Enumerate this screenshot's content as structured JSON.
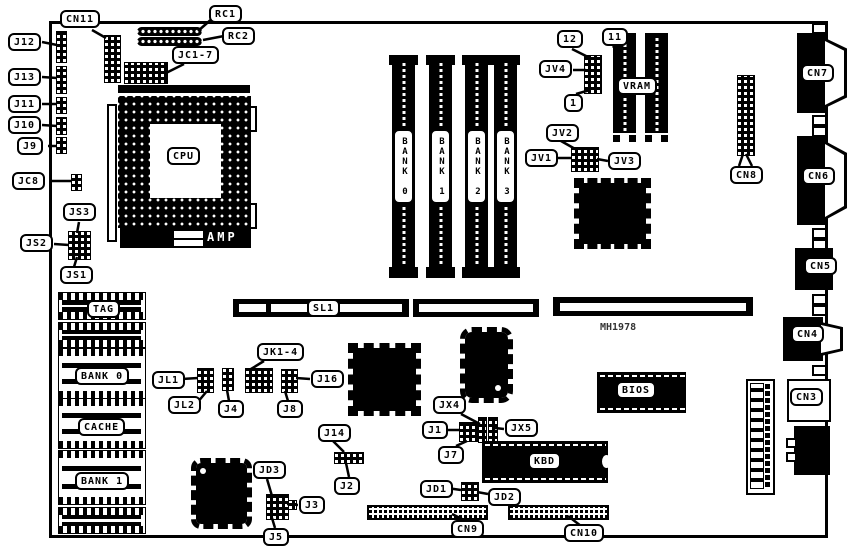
{
  "diagram": {
    "type": "motherboard-component-location-diagram",
    "board_code": "MH1978",
    "ink_color": "#000000",
    "background_color": "#ffffff"
  },
  "labels": {
    "cn11": "CN11",
    "rc1": "RC1",
    "rc2": "RC2",
    "jc1_7": "JC1-7",
    "j12": "J12",
    "j13": "J13",
    "j11": "J11",
    "j10": "J10",
    "j9": "J9",
    "jc8": "JC8",
    "js3": "JS3",
    "js2": "JS2",
    "js1": "JS1",
    "cpu": "CPU",
    "amp": "AMP",
    "p12": "12",
    "p11": "11",
    "jv4": "JV4",
    "p1": "1",
    "jv2": "JV2",
    "jv1": "JV1",
    "jv3": "JV3",
    "vram": "VRAM",
    "cn8": "CN8",
    "cn7": "CN7",
    "cn6": "CN6",
    "cn5": "CN5",
    "cn4": "CN4",
    "cn3": "CN3",
    "tag": "TAG",
    "bank0": "BANK 0",
    "cache": "CACHE",
    "bank1": "BANK 1",
    "sl1": "SL1",
    "mh1978": "MH1978",
    "jl1": "JL1",
    "jl2": "JL2",
    "j4": "J4",
    "jk1_4": "JK1-4",
    "j8": "J8",
    "j16": "J16",
    "j14": "J14",
    "j2": "J2",
    "jd3": "JD3",
    "j3": "J3",
    "j5": "J5",
    "jx4": "JX4",
    "j1": "J1",
    "j7": "J7",
    "jx5": "JX5",
    "jd1": "JD1",
    "jd2": "JD2",
    "kbd": "KBD",
    "bios": "BIOS",
    "cn9": "CN9",
    "cn10": "CN10"
  },
  "simm": [
    "BANK 0",
    "BANK 1",
    "BANK 2",
    "BANK 3"
  ]
}
